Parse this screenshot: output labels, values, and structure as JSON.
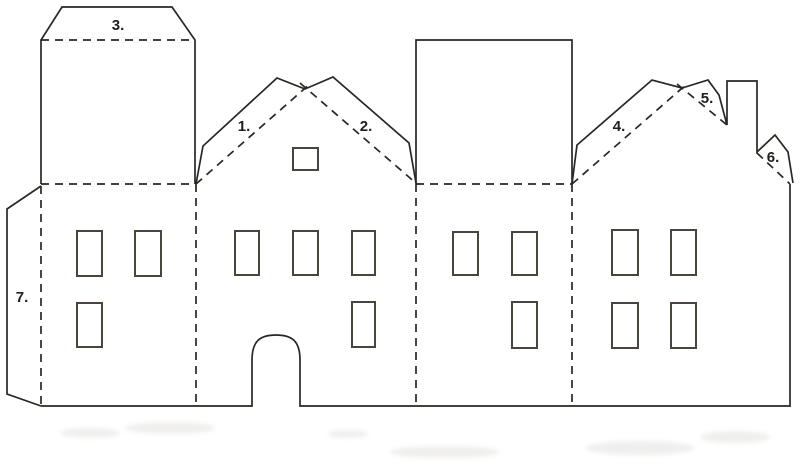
{
  "diagram": {
    "type": "papercraft-house-cutout-template",
    "canvas": {
      "width": 800,
      "height": 471,
      "background": "#ffffff"
    },
    "style": {
      "cut_color": "#2a2623",
      "fold_color": "#2a2623",
      "window_color": "#4a453c",
      "label_color": "#211e1b",
      "dash_pattern": "8 6"
    },
    "labels": [
      {
        "name": "part-label-1",
        "text": "1.",
        "x": 244,
        "y": 131
      },
      {
        "name": "part-label-2",
        "text": "2.",
        "x": 366,
        "y": 131
      },
      {
        "name": "part-label-3",
        "text": "3.",
        "x": 118,
        "y": 30
      },
      {
        "name": "part-label-4",
        "text": "4.",
        "x": 619,
        "y": 131
      },
      {
        "name": "part-label-5",
        "text": "5.",
        "x": 707,
        "y": 103
      },
      {
        "name": "part-label-6",
        "text": "6.",
        "x": 773,
        "y": 162
      },
      {
        "name": "part-label-7",
        "text": "7.",
        "x": 22,
        "y": 302
      }
    ],
    "solid_paths": [
      {
        "name": "tower-roof-panel-outline",
        "d": "M41,184 L41,40 L62,7 L172,7 L195,40 L195,184"
      },
      {
        "name": "left-glue-tab-outline",
        "d": "M41,186 L7,209 L7,394 L41,406"
      },
      {
        "name": "middle-roof-flap-outline",
        "d": "M196,184 L203,146 L277,78 L305,89 L333,77 L409,143 L416,183"
      },
      {
        "name": "flat-roof-panel-outline",
        "d": "M416,184 L416,40 L572,40 L572,184"
      },
      {
        "name": "right-roof-flap-chimney-outline",
        "d": "M572,184 L577,145 L652,80 L682,88 L708,80 L719,95 L727,125 L727,81 L757,81 L757,152 L775,135 L788,152 L793,183"
      },
      {
        "name": "base-door-and-right-edge-outline",
        "d": "M41,406 L252,406 L252,360 C252,341 260,335 276,335 C292,335 300,341 300,360 L300,406 L790,406 L790,184",
        "w": 2.2
      }
    ],
    "dashed_paths": [
      {
        "name": "fold-tab-3",
        "d": "M41,40 L195,40"
      },
      {
        "name": "fold-tower-base",
        "d": "M41,184 L195,184"
      },
      {
        "name": "fold-flat-roof-base",
        "d": "M416,184 L572,184"
      },
      {
        "name": "fold-left-tab",
        "d": "M41,186 L41,406"
      },
      {
        "name": "fold-wall-1-2",
        "d": "M196,184 L196,406"
      },
      {
        "name": "fold-wall-2-3",
        "d": "M416,184 L416,406"
      },
      {
        "name": "fold-wall-3-4",
        "d": "M572,184 L572,406"
      },
      {
        "name": "fold-gable-2-left",
        "d": "M196,184 L311,83"
      },
      {
        "name": "fold-gable-2-right",
        "d": "M300,83 L417,184"
      },
      {
        "name": "fold-gable-4-left",
        "d": "M572,184 L688,83"
      },
      {
        "name": "fold-gable-4-mid",
        "d": "M677,84 L727,125"
      },
      {
        "name": "fold-gable-4-right",
        "d": "M757,153 L790,184"
      }
    ],
    "windows": [
      {
        "name": "wall1-window-upper-left",
        "x": 77,
        "y": 231,
        "w": 25,
        "h": 45
      },
      {
        "name": "wall1-window-upper-right",
        "x": 135,
        "y": 231,
        "w": 26,
        "h": 45
      },
      {
        "name": "wall1-window-lower",
        "x": 77,
        "y": 303,
        "w": 25,
        "h": 44
      },
      {
        "name": "wall2-window-upper-1",
        "x": 235,
        "y": 231,
        "w": 24,
        "h": 44
      },
      {
        "name": "wall2-window-upper-2",
        "x": 293,
        "y": 231,
        "w": 25,
        "h": 44
      },
      {
        "name": "wall2-window-upper-3",
        "x": 352,
        "y": 231,
        "w": 23,
        "h": 44
      },
      {
        "name": "wall2-window-lower",
        "x": 352,
        "y": 302,
        "w": 23,
        "h": 45
      },
      {
        "name": "wall2-gable-window",
        "x": 293,
        "y": 148,
        "w": 25,
        "h": 22
      },
      {
        "name": "wall3-window-upper-left",
        "x": 453,
        "y": 232,
        "w": 25,
        "h": 43
      },
      {
        "name": "wall3-window-upper-right",
        "x": 512,
        "y": 232,
        "w": 25,
        "h": 43
      },
      {
        "name": "wall3-window-lower",
        "x": 512,
        "y": 302,
        "w": 25,
        "h": 46
      },
      {
        "name": "wall4-window-upper-left",
        "x": 612,
        "y": 230,
        "w": 26,
        "h": 45
      },
      {
        "name": "wall4-window-upper-right",
        "x": 671,
        "y": 230,
        "w": 25,
        "h": 45
      },
      {
        "name": "wall4-window-lower-left",
        "x": 612,
        "y": 303,
        "w": 26,
        "h": 45
      },
      {
        "name": "wall4-window-lower-right",
        "x": 671,
        "y": 303,
        "w": 25,
        "h": 45
      }
    ],
    "smudges": [
      {
        "cx": 90,
        "cy": 433,
        "rx": 30,
        "ry": 5
      },
      {
        "cx": 170,
        "cy": 428,
        "rx": 45,
        "ry": 6
      },
      {
        "cx": 348,
        "cy": 434,
        "rx": 20,
        "ry": 4
      },
      {
        "cx": 445,
        "cy": 452,
        "rx": 55,
        "ry": 6
      },
      {
        "cx": 640,
        "cy": 448,
        "rx": 55,
        "ry": 7
      },
      {
        "cx": 735,
        "cy": 437,
        "rx": 35,
        "ry": 6
      }
    ]
  }
}
